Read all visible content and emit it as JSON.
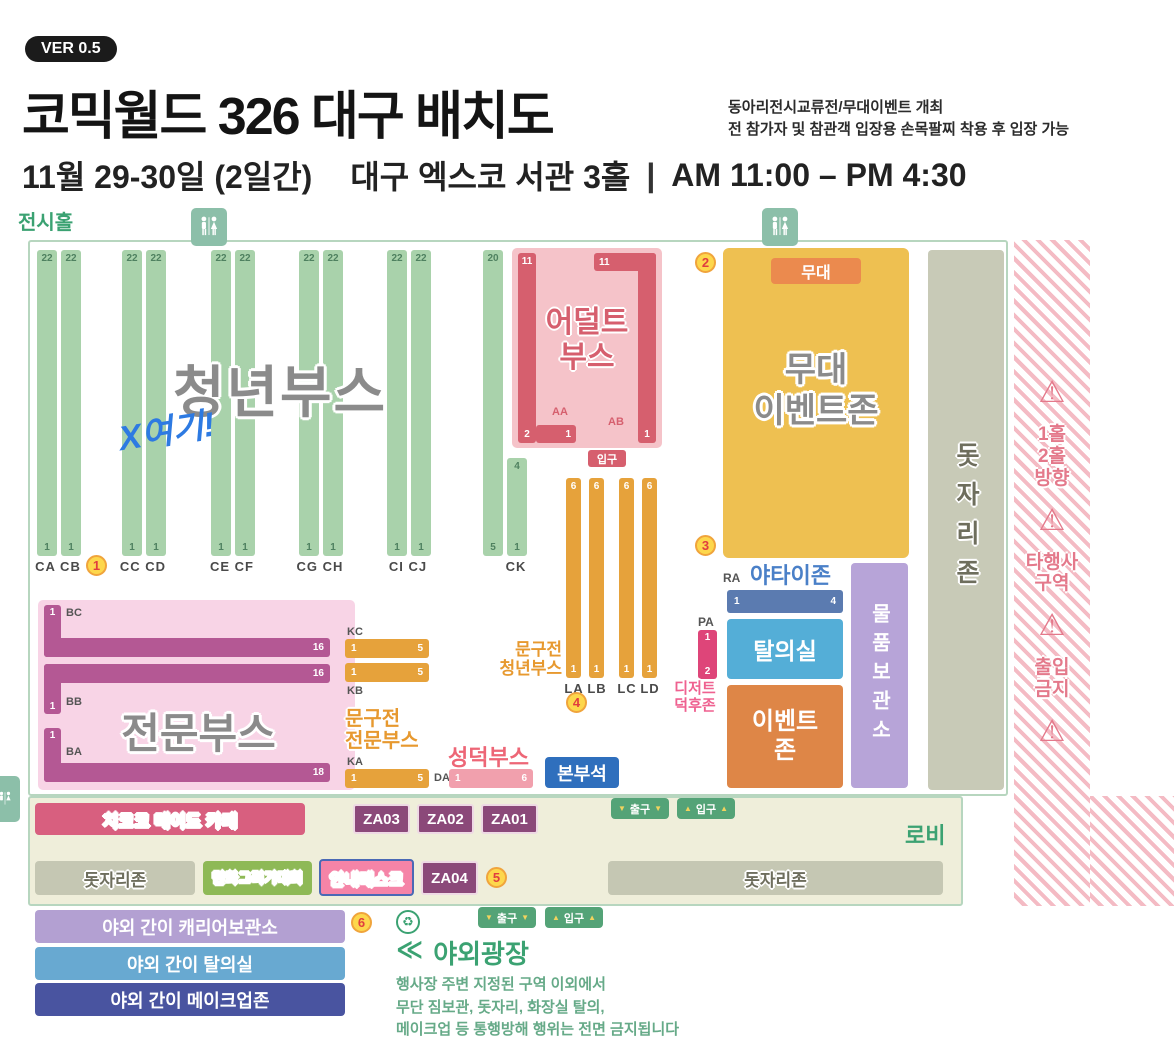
{
  "header": {
    "version": "VER 0.5",
    "title": "코믹월드 326 대구 배치도",
    "note1": "동아리전시교류전/무대이벤트 개최",
    "note2": "전 참가자 및 참관객 입장용 손목팔찌 착용 후 입장 가능",
    "date": "11월 29-30일 (2일간)",
    "venue": "대구 엑스코 서관 3홀",
    "sep": "|",
    "time": "AM 11:00 – PM 4:30"
  },
  "labels": {
    "hall": "전시홀",
    "lobby": "로비"
  },
  "markers": [
    "1",
    "2",
    "3",
    "4",
    "5",
    "6"
  ],
  "youth": {
    "title": "청년부스",
    "note": "X여기!",
    "bars": [
      {
        "top": "22",
        "bottom": "1"
      },
      {
        "top": "22",
        "bottom": "1"
      },
      {
        "top": "22",
        "bottom": "1"
      },
      {
        "top": "22",
        "bottom": "1"
      },
      {
        "top": "22",
        "bottom": "1"
      },
      {
        "top": "22",
        "bottom": "1"
      },
      {
        "top": "22",
        "bottom": "1"
      },
      {
        "top": "22",
        "bottom": "1"
      },
      {
        "top": "22",
        "bottom": "1"
      },
      {
        "top": "22",
        "bottom": "1"
      },
      {
        "top": "20",
        "bottom": "5"
      },
      {
        "top": "4",
        "bottom": "1"
      }
    ],
    "groups": [
      "CA CB",
      "CC CD",
      "CE CF",
      "CG CH",
      "CI CJ"
    ],
    "ck": "CK"
  },
  "adult": {
    "line1": "어덜트",
    "line2": "부스",
    "aa": "AA",
    "ab": "AB",
    "v_top": "11",
    "v_bottom": "2",
    "h_right": "1",
    "top_left": "11",
    "top_right": "10",
    "r_bottom": "1",
    "entrance": "입구"
  },
  "stage": {
    "badge": "무대",
    "line1": "무대",
    "line2": "이벤트존"
  },
  "mat_strip": "돗자리존",
  "restricted": {
    "warn": "⚠",
    "hall_dir": [
      "1홀",
      "2홀",
      "방향"
    ],
    "other": [
      "타행사",
      "구역"
    ],
    "noentry": [
      "출입",
      "금지"
    ]
  },
  "pro": {
    "title": "전문부스",
    "bc": {
      "label": "BC",
      "v": "1",
      "h": "16"
    },
    "bb": {
      "label": "BB",
      "v": "1",
      "h": "16"
    },
    "ba": {
      "label": "BA",
      "v": "1",
      "h": "18"
    }
  },
  "spro": {
    "line1": "문구전",
    "line2": "전문부스",
    "kc": "KC",
    "kb": "KB",
    "ka": "KA",
    "kc_l": "1",
    "kc_r": "5",
    "kb_l": "1",
    "kb_r": "5",
    "ka_l": "1",
    "ka_r": "5"
  },
  "syouth": {
    "line1": "문구전",
    "line2": "청년부스",
    "bars": [
      {
        "top": "6",
        "bottom": "1"
      },
      {
        "top": "6",
        "bottom": "1"
      },
      {
        "top": "6",
        "bottom": "1"
      },
      {
        "top": "6",
        "bottom": "1"
      }
    ],
    "names": [
      "LA",
      "LB",
      "LC",
      "LD"
    ]
  },
  "seong": {
    "title": "성덕부스",
    "da": "DA",
    "l": "1",
    "r": "6"
  },
  "hq": "본부석",
  "yatai": {
    "title": "야타이존",
    "ra": "RA",
    "ra_l": "1",
    "ra_r": "4",
    "pa": "PA",
    "pa_t": "1",
    "pa_b": "2"
  },
  "changing": "탈의실",
  "dessert": {
    "line1": "디저트",
    "line2": "덕후존"
  },
  "eventzone": {
    "line1": "이벤트",
    "line2": "존"
  },
  "storage": "물품보관소",
  "lobby": {
    "maid": "치코코 메이드 카페",
    "za03": "ZA03",
    "za02": "ZA02",
    "za01": "ZA01",
    "za04": "ZA04",
    "exit": "출구",
    "enter": "입구",
    "down": "▼",
    "up": "▲",
    "mat_left": "돗자리존",
    "mat_right": "돗자리존",
    "drawing": "만화그리기대회",
    "info": "안내데스크"
  },
  "outdoor": {
    "carrier": "야외 간이 캐리어보관소",
    "changing": "야외 간이 탈의실",
    "makeup": "야외 간이 메이크업존",
    "recycle": "♻",
    "plaza_prefix": "≪",
    "plaza": "야외광장",
    "rule1": "행사장 주변 지정된 구역 이외에서",
    "rule2": "무단 짐보관, 돗자리, 화장실 탈의,",
    "rule3": "메이크업 등 통행방해 행위는 전면 금지됩니다"
  },
  "colors": {
    "accent_green": "#3ba272",
    "warn_pink": "#e4798b",
    "stage_yellow": "#eec051",
    "adult_red": "#d65f6e",
    "pro_magenta": "#b45894",
    "orange": "#e6a23b",
    "hq_blue": "#2f6fbd",
    "za_purple": "#8b4979"
  }
}
